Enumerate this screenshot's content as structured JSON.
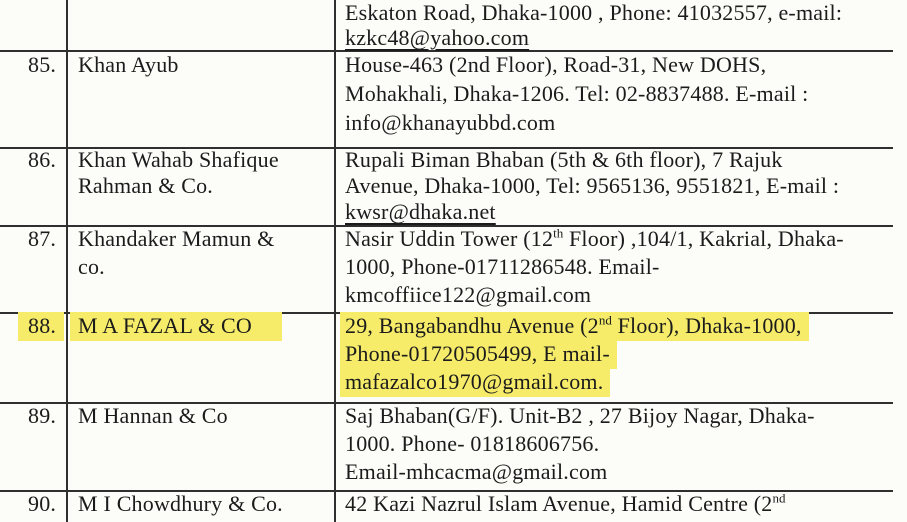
{
  "document": {
    "type": "scanned-directory-table",
    "colors": {
      "paper": "#fcfcf9",
      "ink": "#1b1b1b",
      "rule_lines": "#2f2f2f",
      "highlight": "#f6ec6a"
    },
    "partial_row": {
      "address_line1": "Eskaton Road, Dhaka-1000 , Phone: 41032557, e-mail:",
      "address_line2": "kzkc48@yahoo.com"
    },
    "row85": {
      "no": "85.",
      "name": "Khan Ayub",
      "a1": "House-463 (2nd Floor), Road-31, New DOHS,",
      "a2": "Mohakhali, Dhaka-1206. Tel: 02-8837488. E-mail :",
      "a3": "info@khanayubbd.com"
    },
    "row86": {
      "no": "86.",
      "name1": "Khan Wahab Shafique",
      "name2": "Rahman & Co.",
      "a1": "Rupali Biman Bhaban (5th & 6th floor), 7 Rajuk",
      "a2": "Avenue, Dhaka-1000, Tel: 9565136, 9551821, E-mail :",
      "a3": "kwsr@dhaka.net"
    },
    "row87": {
      "no": "87.",
      "name1": "Khandaker Mamun &",
      "name2": "co.",
      "a1_pre": "Nasir Uddin Tower (12",
      "a1_sup": "th",
      "a1_post": " Floor) ,104/1, Kakrial, Dhaka-",
      "a2": "1000, Phone-01711286548. Email-",
      "a3": "kmcoffiice122@gmail.com"
    },
    "row88": {
      "no": "88.",
      "name": "M A FAZAL & CO",
      "a1_pre": "29, Bangabandhu Avenue (2",
      "a1_sup": "nd",
      "a1_post": " Floor), Dhaka-1000,",
      "a2": "Phone-01720505499, E mail-",
      "a3": "mafazalco1970@gmail.com.",
      "highlighted": true
    },
    "row89": {
      "no": "89.",
      "name": "M Hannan & Co",
      "a1": "Saj Bhaban(G/F). Unit-B2 , 27 Bijoy Nagar, Dhaka-",
      "a2": "1000. Phone- 01818606756.",
      "a3": "Email-mhcacma@gmail.com"
    },
    "row90": {
      "no": "90.",
      "name": "M I Chowdhury & Co.",
      "a1_pre": "42 Kazi Nazrul Islam Avenue, Hamid Centre (2",
      "a1_sup": "nd"
    }
  }
}
